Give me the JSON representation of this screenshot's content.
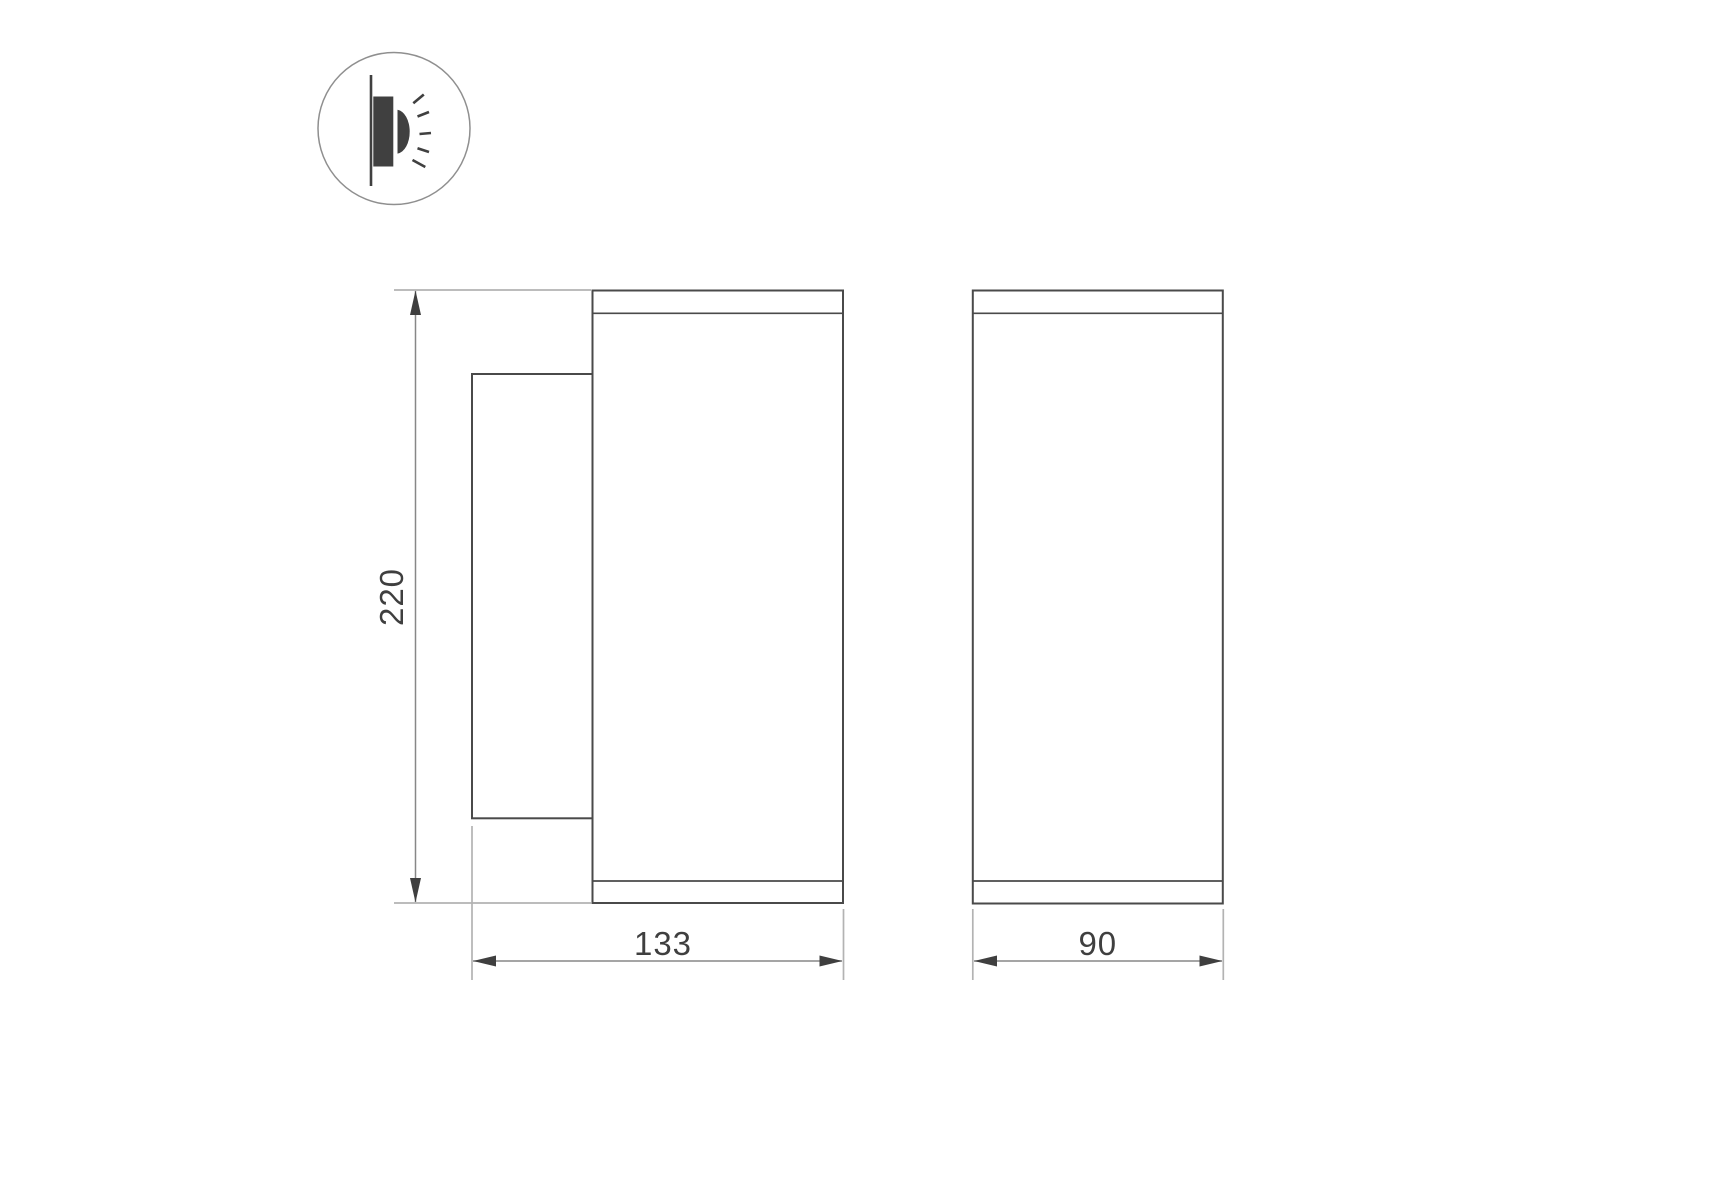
{
  "drawing": {
    "type": "technical-dimension-drawing",
    "background_color": "#ffffff",
    "colors": {
      "object_line": "#4a4a4a",
      "extension_line": "#b3b3b3",
      "dimension_line": "#878787",
      "arrow": "#3f3f3f",
      "label_text": "#3f3f3f",
      "icon_glyph": "#404040",
      "icon_circle": "#8f8f8f"
    },
    "icon": {
      "name": "wall-mounted-light-icon"
    },
    "dimension_labels": {
      "height": "220",
      "depth": "133",
      "width": "90"
    }
  }
}
